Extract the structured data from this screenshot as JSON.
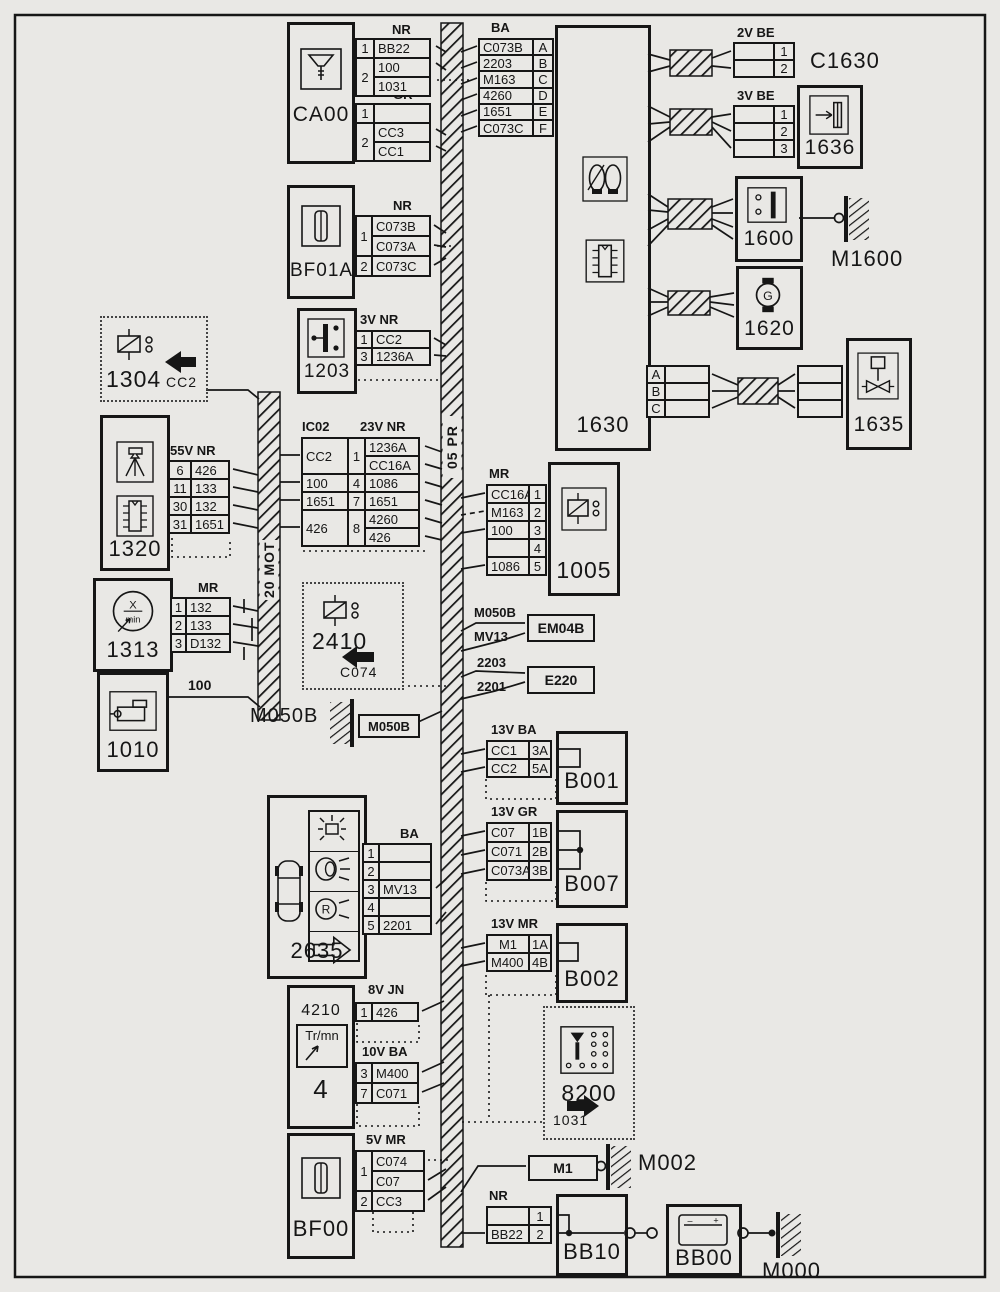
{
  "colors": {
    "ink": "#161616",
    "paper": "#e9e8e5"
  },
  "buses": {
    "main": "05 PR",
    "motor": "20 MOT"
  },
  "components": {
    "ca00": {
      "name": "CA00"
    },
    "bf01a": {
      "name": "BF01A"
    },
    "s1203": {
      "name": "1203"
    },
    "r1304": {
      "name": "1304",
      "connector": "CC2"
    },
    "e1320": {
      "name": "1320"
    },
    "t1313": {
      "name": "1313"
    },
    "m1010": {
      "name": "1010"
    },
    "r2410": {
      "name": "2410",
      "connector": "C074"
    },
    "c2635": {
      "name": "2635"
    },
    "g4210": {
      "name": "4210",
      "unit": "Tr/mn",
      "panel": "4"
    },
    "bf00": {
      "name": "BF00"
    },
    "e1630": {
      "name": "1630"
    },
    "c1630": {
      "name": "C1630"
    },
    "s1636": {
      "name": "1636"
    },
    "s1600": {
      "name": "1600"
    },
    "m1600": {
      "name": "M1600"
    },
    "a1620": {
      "name": "1620"
    },
    "i1635": {
      "name": "1635"
    },
    "r1005": {
      "name": "1005"
    },
    "em04b": {
      "name": "EM04B"
    },
    "e220": {
      "name": "E220"
    },
    "b001": {
      "name": "B001"
    },
    "b007": {
      "name": "B007"
    },
    "b002": {
      "name": "B002"
    },
    "c8200": {
      "name": "8200",
      "connector": "1031"
    },
    "m1": {
      "name": "M1"
    },
    "m002": {
      "name": "M002"
    },
    "bb10": {
      "name": "BB10"
    },
    "bb00": {
      "name": "BB00"
    },
    "m000": {
      "name": "M000"
    },
    "m050b": {
      "name": "M050B",
      "box": "M050B"
    }
  },
  "wire_labels": {
    "starter": "100",
    "m050b": "M050B",
    "mv13": "MV13",
    "w2203": "2203",
    "w2201": "2201"
  },
  "icon_text": {
    "rpm_x": "X",
    "rpm_min": "min",
    "alt_g": "G",
    "rev_r": "R",
    "bat_neg": "–",
    "bat_pos": "+"
  },
  "tables": {
    "ca00_nr": {
      "header": "NR",
      "rows": [
        [
          "1",
          "BB22"
        ],
        [
          {
            "t": "2",
            "rs": 2
          },
          "100"
        ],
        [
          "1031"
        ]
      ]
    },
    "ca00_gr": {
      "header": "GR",
      "rows": [
        [
          "1",
          ""
        ],
        [
          {
            "t": "2",
            "rs": 2
          },
          "CC3"
        ],
        [
          "CC1"
        ]
      ]
    },
    "ba_top": {
      "header": "BA",
      "rows": [
        [
          "C073B",
          "A"
        ],
        [
          "2203",
          "B"
        ],
        [
          "M163",
          "C"
        ],
        [
          "4260",
          "D"
        ],
        [
          "1651",
          "E"
        ],
        [
          "C073C",
          "F"
        ]
      ]
    },
    "be2v": {
      "header": "2V BE",
      "rows": [
        [
          "",
          "1"
        ],
        [
          "",
          "2"
        ]
      ]
    },
    "be3v": {
      "header": "3V BE",
      "rows": [
        [
          "",
          "1"
        ],
        [
          "",
          "2"
        ],
        [
          "",
          "3"
        ]
      ]
    },
    "abc1630": {
      "rows": [
        [
          "A",
          ""
        ],
        [
          "B",
          ""
        ],
        [
          "C",
          ""
        ]
      ]
    },
    "abc1635": {
      "rows": [
        [
          ""
        ],
        [
          ""
        ],
        [
          ""
        ]
      ]
    },
    "bf01a_nr": {
      "header": "NR",
      "rows": [
        [
          {
            "t": "1",
            "rs": 2
          },
          "C073B"
        ],
        [
          "C073A"
        ],
        [
          "2",
          "C073C"
        ]
      ]
    },
    "t1203": {
      "header": "3V NR",
      "rows": [
        [
          "1",
          "CC2"
        ],
        [
          "3",
          "1236A"
        ]
      ]
    },
    "t1320": {
      "header": "55V NR",
      "rows": [
        [
          "6",
          "426"
        ],
        [
          "11",
          "133"
        ],
        [
          "30",
          "132"
        ],
        [
          "31",
          "1651"
        ]
      ]
    },
    "ic02": {
      "header_left": "IC02",
      "header_right": "23V NR",
      "rows": [
        [
          {
            "t": "CC2",
            "rs": 2
          },
          {
            "t": "1",
            "rs": 2
          },
          "1236A"
        ],
        [
          "CC16A"
        ],
        [
          "100",
          "4",
          "1086"
        ],
        [
          "1651",
          "7",
          "1651"
        ],
        [
          {
            "t": "426",
            "rs": 2
          },
          {
            "t": "8",
            "rs": 2
          },
          "4260"
        ],
        [
          "426"
        ]
      ]
    },
    "t1005": {
      "header": "MR",
      "rows": [
        [
          "CC16A",
          "1"
        ],
        [
          "M163",
          "2"
        ],
        [
          "100",
          "3"
        ],
        [
          "",
          "4"
        ],
        [
          "1086",
          "5"
        ]
      ]
    },
    "t1313": {
      "header": "MR",
      "rows": [
        [
          "1",
          "132"
        ],
        [
          "2",
          "133"
        ],
        [
          "3",
          "D132"
        ]
      ]
    },
    "b001": {
      "header": "13V BA",
      "rows": [
        [
          "CC1",
          "3A"
        ],
        [
          "CC2",
          "5A"
        ]
      ]
    },
    "b007": {
      "header": "13V GR",
      "rows": [
        [
          "C07",
          "1B"
        ],
        [
          "C071",
          "2B"
        ],
        [
          "C073A",
          "3B"
        ]
      ]
    },
    "t2635": {
      "header": "BA",
      "rows": [
        [
          "1",
          ""
        ],
        [
          "2",
          ""
        ],
        [
          "3",
          "MV13"
        ],
        [
          "4",
          ""
        ],
        [
          "5",
          "2201"
        ]
      ]
    },
    "b002": {
      "header": "13V MR",
      "rows": [
        [
          "M1",
          "1A"
        ],
        [
          "M400",
          "4B"
        ]
      ]
    },
    "jn8v": {
      "header": "8V JN",
      "rows": [
        [
          "1",
          "426"
        ]
      ]
    },
    "ba10v": {
      "header": "10V BA",
      "rows": [
        [
          "3",
          "M400"
        ],
        [
          "7",
          "C071"
        ]
      ]
    },
    "bf00_mr": {
      "header": "5V MR",
      "rows": [
        [
          {
            "t": "1",
            "rs": 2
          },
          "C074"
        ],
        [
          "C07"
        ],
        [
          "2",
          "CC3"
        ]
      ]
    },
    "bb10_nr": {
      "header": "NR",
      "rows": [
        [
          "",
          "1"
        ],
        [
          "BB22",
          "2"
        ]
      ]
    }
  }
}
